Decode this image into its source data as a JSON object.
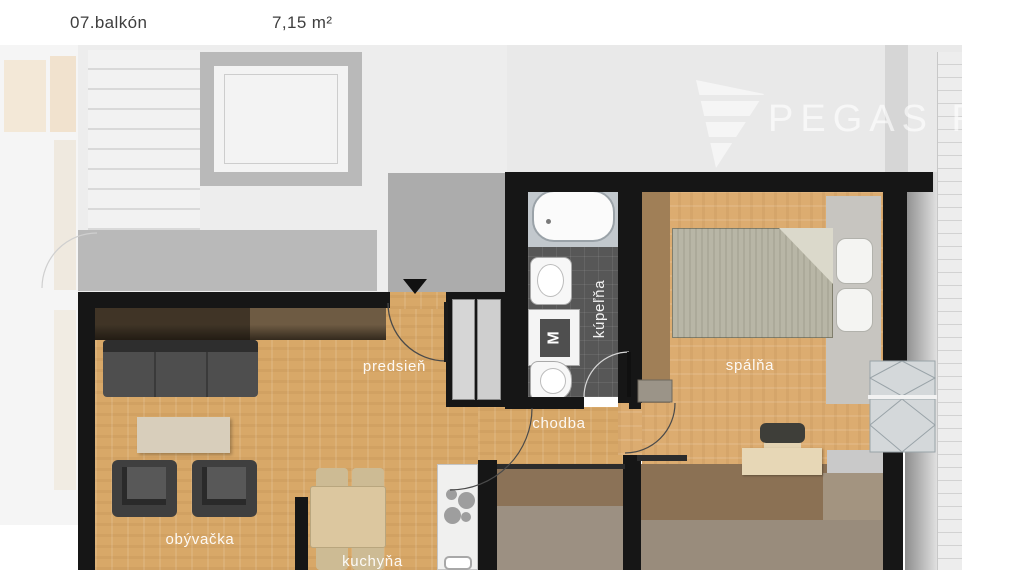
{
  "header": {
    "balcony_label": "07.balkón",
    "balcony_area": "7,15 m²"
  },
  "watermark": {
    "brand": "PEGAS REAL"
  },
  "rooms": {
    "hallway": {
      "label": "predsieň"
    },
    "corridor": {
      "label": "chodba"
    },
    "bathroom": {
      "label": "kúpeľňa"
    },
    "bedroom": {
      "label": "spálňa"
    },
    "living": {
      "label": "obývačka"
    },
    "kitchen": {
      "label": "kuchyňa"
    }
  },
  "fixtures": {
    "washer_label": "M"
  },
  "colors": {
    "wall": "#161616",
    "wood_floor": "#d8a868",
    "bath_floor": "#575757",
    "faded_wall": "#b9b9b9",
    "faded_bg": "#ececec",
    "band_brown": "#8b7257",
    "band_taupe": "#9c9082",
    "room_label_text": "#ffffff",
    "header_text": "#3e3e3e"
  }
}
